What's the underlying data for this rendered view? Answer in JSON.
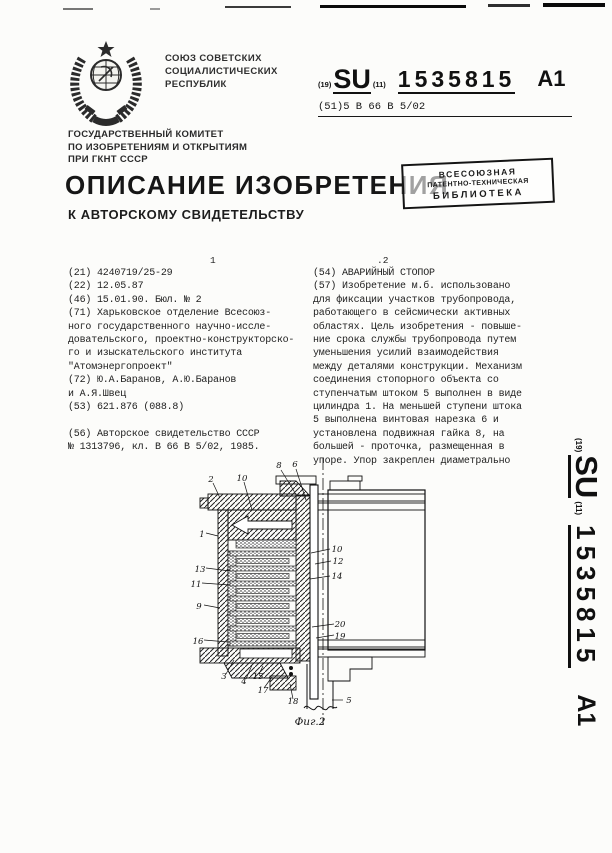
{
  "header": {
    "country_lines": [
      "СОЮЗ СОВЕТСКИХ",
      "СОЦИАЛИСТИЧЕСКИХ",
      "РЕСПУБЛИК"
    ],
    "committee_lines": [
      "ГОСУДАРСТВЕННЫЙ КОМИТЕТ",
      "ПО ИЗОБРЕТЕНИЯМ И ОТКРЫТИЯМ",
      "ПРИ ГКНТ СССР"
    ],
    "title": "ОПИСАНИЕ ИЗОБРЕТЕНИЯ",
    "subtitle": "К АВТОРСКОМУ СВИДЕТЕЛЬСТВУ",
    "publication": {
      "code19": "(19)",
      "country": "SU",
      "code11": "(11)",
      "number": "1535815",
      "kind": "А1"
    },
    "ipc_line": "(51)5 В 66 В 5/02",
    "library_stamp_lines": [
      "ВСЕСОЮЗНАЯ",
      "ПАТЕНТНО-ТЕХНИЧЕСКАЯ",
      "БИБЛИОТЕКА"
    ]
  },
  "columns": {
    "left_page_no": "1",
    "right_page_no": ".2",
    "left_lines": [
      "(21) 4240719/25-29",
      "(22) 12.05.87",
      "(46) 15.01.90. Бюл. № 2",
      "(71) Харьковское отделение Всесоюз-",
      "ного государственного научно-иссле-",
      "довательского, проектно-конструкторско-",
      "го и изыскательского института",
      "\"Атомэнергопроект\"",
      "(72) Ю.А.Баранов, А.Ю.Баранов",
      "и А.Я.Швец",
      "(53) 621.876 (088.8)",
      "",
      "(56) Авторское свидетельство СССР",
      "№ 1313796, кл. В 66 В 5/02, 1985."
    ],
    "right_lines": [
      "(54) АВАРИЙНЫЙ СТОПОР",
      "(57) Изобретение м.б. использовано",
      "для фиксации участков трубопровода,",
      "работающего в сейсмически активных",
      "областях. Цель изобретения - повыше-",
      "ние срока службы трубопровода путем",
      "уменьшения усилий взаимодействия",
      "между деталями конструкции. Механизм",
      "соединения стопорного объекта со",
      "ступенчатым штоком 5 выполнен в виде",
      "цилиндра 1. На меньшей ступени штока",
      "5 выполнена винтовая нарезка 6 и",
      "установлена подвижная гайка 8, на",
      "большей - проточка, размещенная в",
      "упоре. Упор закреплен диаметрально"
    ]
  },
  "figure": {
    "caption": "Фиг.2",
    "callouts": [
      "2",
      "10",
      "8",
      "6",
      "1",
      "13",
      "11",
      "9",
      "16",
      "10",
      "12",
      "14",
      "20",
      "19",
      "3",
      "4",
      "15",
      "17",
      "18",
      "5"
    ]
  },
  "sidebar": {
    "code19": "(19)",
    "country": "SU",
    "code11": "(11)",
    "number": "1535815",
    "kind": "А1"
  },
  "colors": {
    "ink": "#1b1b1b",
    "paper": "#fcfcfa"
  }
}
